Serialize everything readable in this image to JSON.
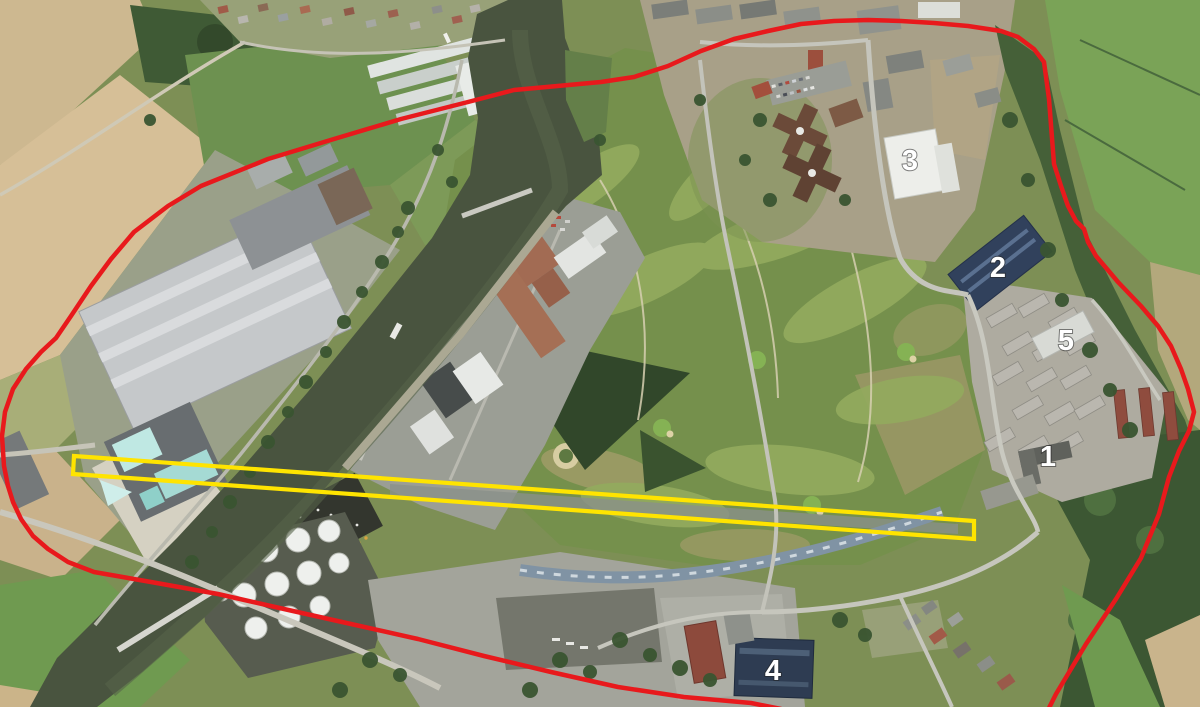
{
  "page": {
    "title": "Satellite aerial map with site boundary and highlighted strip"
  },
  "annotations": {
    "label_color": "#ffffff",
    "boundary": {
      "description": "red site boundary outline",
      "color": "#e8191c",
      "stroke_width": 4.5,
      "path": "M 2,436 L 5,412 L 13,389 L 26,369 L 41,352 L 56,338 L 71,316 L 91,286 L 111,259 L 134,232 L 168,206 L 201,186 L 268,159 L 334,139 L 401,119 L 468,102 L 514,90 L 601,82 L 634,77 L 668,66 L 701,51 L 734,39 L 768,31 L 801,24 L 834,21 L 868,20 L 901,21 L 934,23 L 968,26 L 1001,31 L 1018,37 L 1034,49 L 1044,62 L 1049,99 L 1054,164 L 1061,186 L 1068,206 L 1076,221 L 1084,229 L 1088,242 L 1096,256 L 1118,282 L 1141,306 L 1158,326 L 1171,346 L 1181,369 L 1188,389 L 1194,412 L 1189,431 L 1179,451 L 1169,477 L 1159,514 L 1141,558 L 1116,599 L 1086,644 L 1056,694 L 1046,714 L 1030,728 L 900,734 L 800,722 L 781,709 L 751,703 L 684,697 L 618,687 L 551,672 L 484,656 L 418,639 L 351,624 L 284,609 L 218,594 L 151,582 L 94,572 L 68,562 L 48,549 L 33,536 L 21,519 L 13,502 L 8,486 L 4,466 Z"
    },
    "highlight": {
      "description": "yellow highlighted long strip",
      "color": "#ffe400",
      "stroke_width": 4.2,
      "points": "74,456 974,521 974,539 73,474"
    },
    "labels": [
      {
        "text": "1",
        "x": 1048,
        "y": 466
      },
      {
        "text": "2",
        "x": 998,
        "y": 277
      },
      {
        "text": "3",
        "x": 910,
        "y": 170
      },
      {
        "text": "4",
        "x": 773,
        "y": 680
      },
      {
        "text": "5",
        "x": 1066,
        "y": 350
      }
    ]
  }
}
